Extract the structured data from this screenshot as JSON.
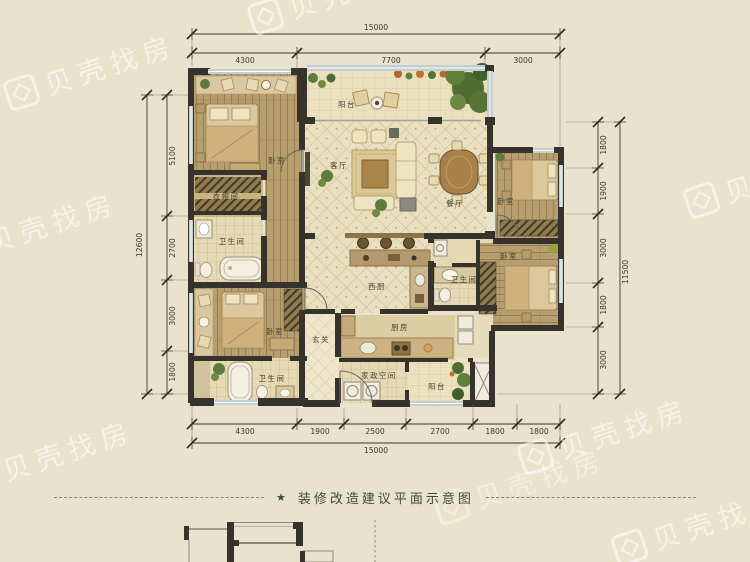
{
  "watermark": {
    "brand": "贝壳找房"
  },
  "caption": {
    "star": "★",
    "text": "装修改造建议平面示意图"
  },
  "dimensions": {
    "top": {
      "total": "15000",
      "segments": [
        "4300",
        "7700",
        "3000"
      ]
    },
    "bottom": {
      "total": "15000",
      "segments": [
        "4300",
        "1900",
        "2500",
        "2700",
        "1800",
        "1800"
      ]
    },
    "left": {
      "total": "12600",
      "segments": [
        "5100",
        "2700",
        "3000",
        "1800"
      ]
    },
    "right": {
      "total": "11500",
      "segments": [
        "1800",
        "1900",
        "3000",
        "1800",
        "3000"
      ]
    }
  },
  "rooms": {
    "bedroom_top_left": "卧室",
    "cloakroom": "衣帽间",
    "bathroom_top_left": "卫生间",
    "balcony_top": "阳台",
    "living_room": "客厅",
    "dining_room": "餐厅",
    "bedroom_top_right": "卧室",
    "bedroom_mid_right": "卧室",
    "bathroom_mid_right": "卫生间",
    "west_kitchen": "西厨",
    "entry": "玄关",
    "bedroom_bottom_left": "卧室",
    "bathroom_bottom_left": "卫生间",
    "kitchen": "厨房",
    "housekeeping": "家政空间",
    "balcony_bottom": "阳台"
  },
  "colors": {
    "background": "#e9e2cc",
    "wall": "#35332c",
    "window": "#c3ced1",
    "wood": "#b69e70",
    "tile": "#e9dfc1",
    "caption_text": "#3f4a3c"
  }
}
